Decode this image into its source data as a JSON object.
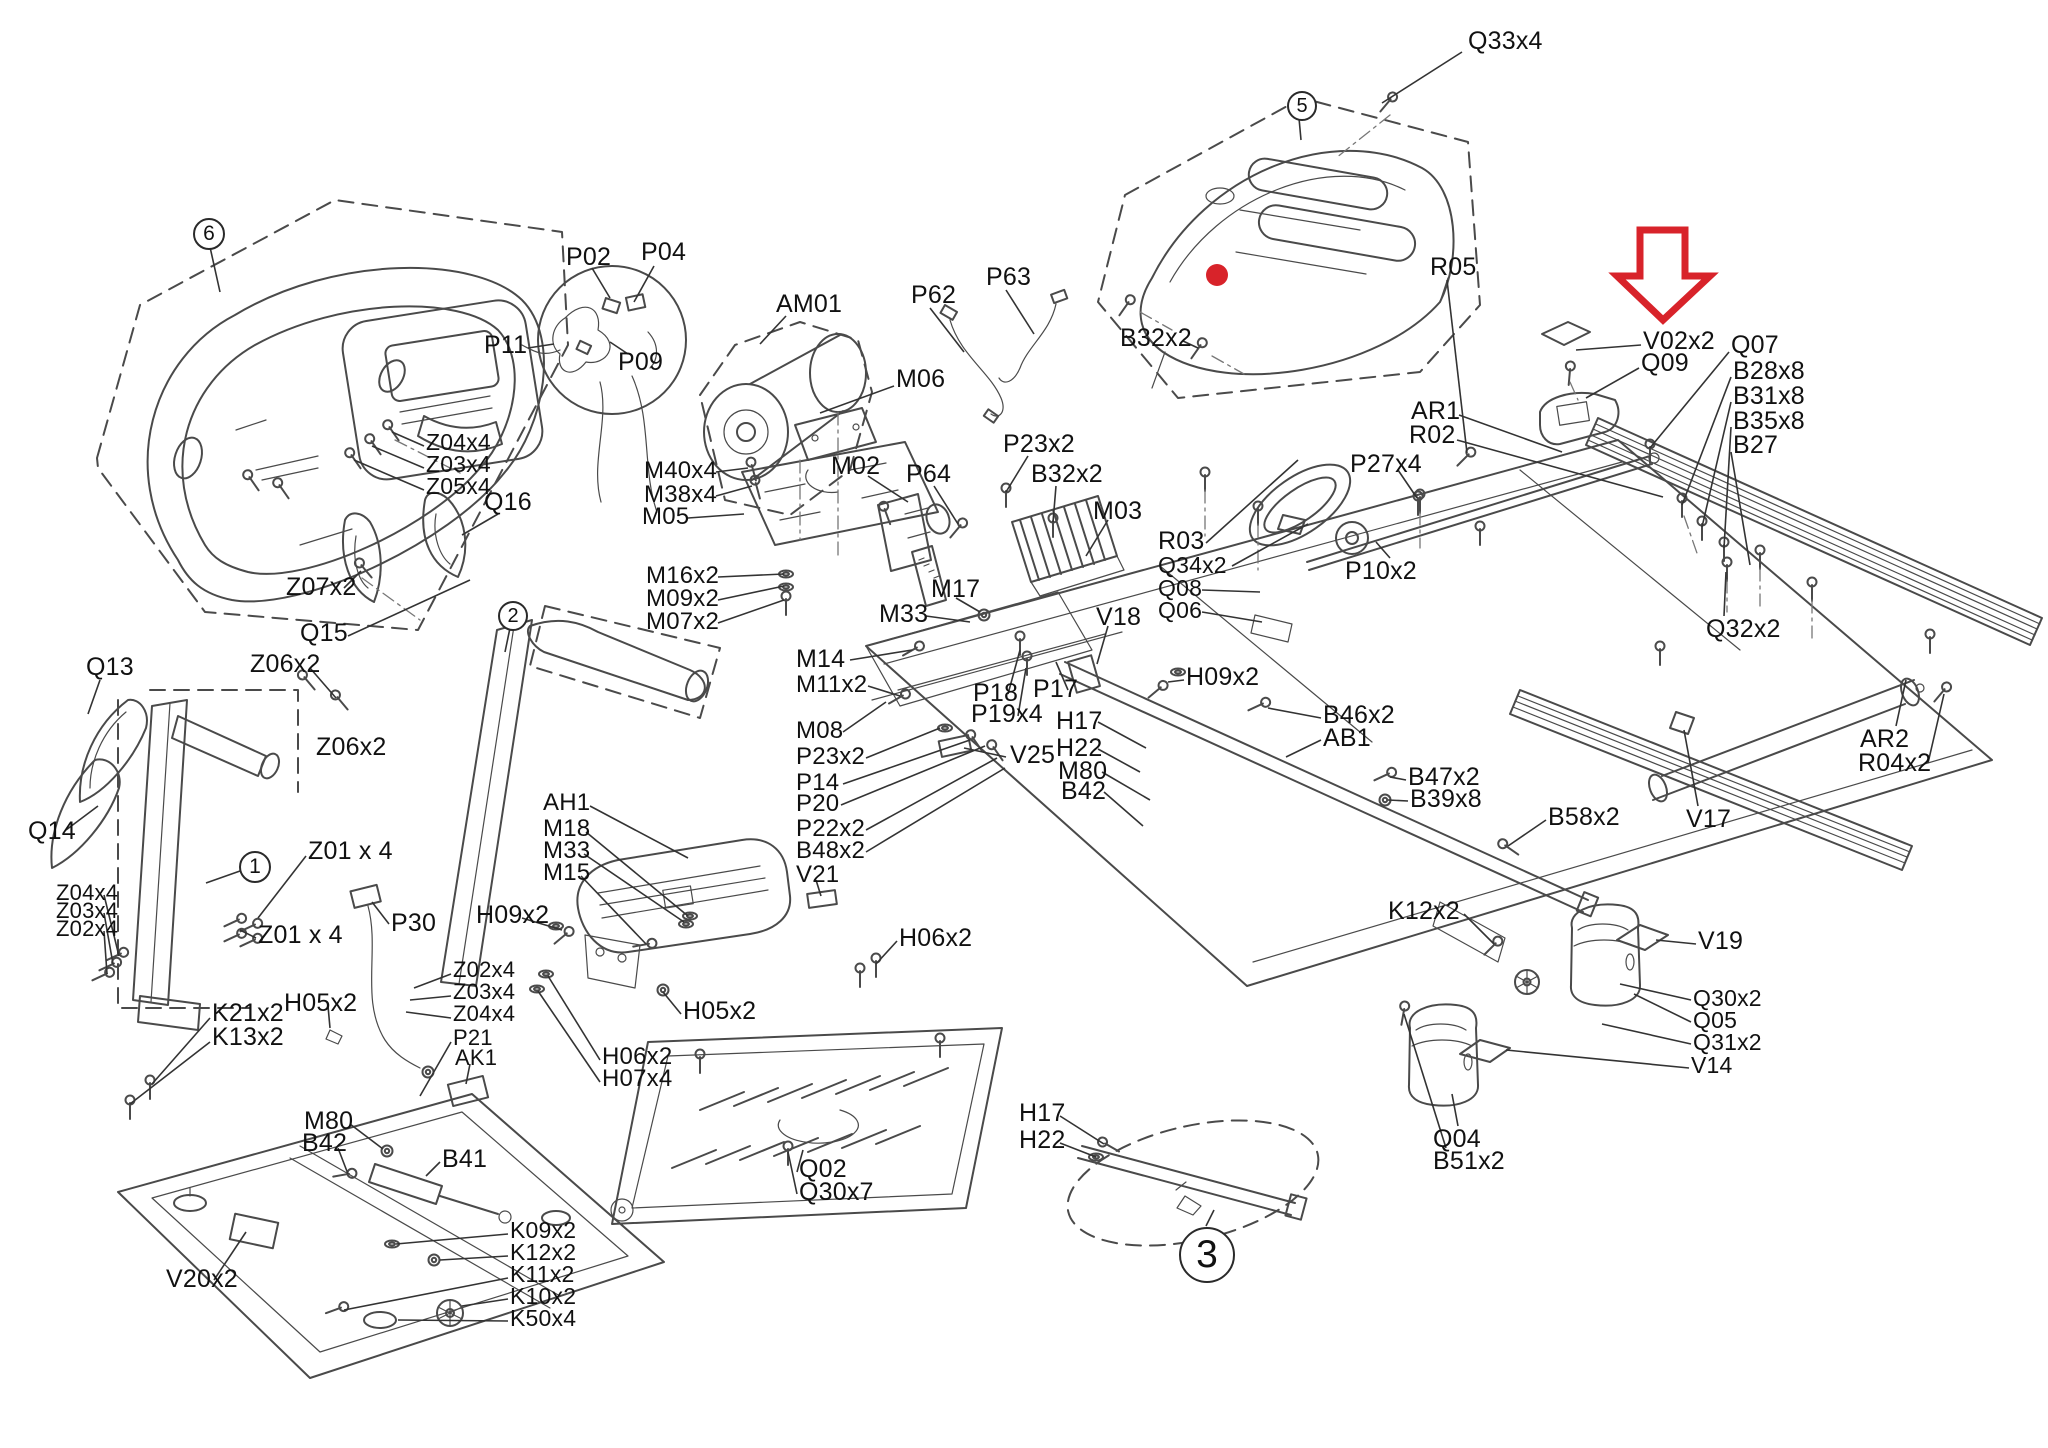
{
  "diagram_type": "exploded-parts-diagram",
  "subject": "treadmill parts schematic",
  "colors": {
    "line": "#4a4a4a",
    "label": "#111111",
    "red": "#d8232a",
    "bg": "#ffffff"
  },
  "highlight": {
    "arrow": {
      "x": 1617,
      "y": 228
    },
    "dot": {
      "x": 1217,
      "y": 275,
      "r": 11
    }
  },
  "balloons": [
    {
      "n": "6",
      "x": 207,
      "y": 232,
      "r": 14,
      "l": [
        210,
        247,
        220,
        292
      ]
    },
    {
      "n": "2",
      "x": 511,
      "y": 614,
      "r": 13,
      "l": [
        510,
        628,
        505,
        652
      ]
    },
    {
      "n": "1",
      "x": 253,
      "y": 865,
      "r": 14,
      "l": [
        240,
        871,
        206,
        883
      ]
    },
    {
      "n": "5",
      "x": 1300,
      "y": 104,
      "r": 13,
      "l": [
        1299,
        118,
        1301,
        140
      ]
    },
    {
      "n": "3",
      "x": 1205,
      "y": 1253,
      "r": 26,
      "l": [
        1206,
        1226,
        1214,
        1210
      ]
    }
  ],
  "callouts": [
    {
      "t": "Q33x4",
      "x": 1468,
      "y": 30,
      "l": [
        1462,
        52,
        1382,
        103
      ]
    },
    {
      "t": "V02x2",
      "x": 1643,
      "y": 330,
      "l": [
        1641,
        345,
        1576,
        350
      ]
    },
    {
      "t": "Q09",
      "x": 1641,
      "y": 352,
      "l": [
        1639,
        368,
        1586,
        398
      ]
    },
    {
      "t": "Q07",
      "x": 1731,
      "y": 334,
      "l": [
        1729,
        352,
        1650,
        448
      ]
    },
    {
      "t": "B28x8",
      "x": 1733,
      "y": 360,
      "l": [
        1731,
        377,
        1682,
        505
      ]
    },
    {
      "t": "B31x8",
      "x": 1733,
      "y": 385,
      "l": [
        1731,
        402,
        1702,
        527
      ]
    },
    {
      "t": "B35x8",
      "x": 1733,
      "y": 410,
      "l": [
        1731,
        427,
        1724,
        548
      ]
    },
    {
      "t": "B27",
      "x": 1733,
      "y": 434,
      "l": [
        1731,
        452,
        1750,
        565
      ]
    },
    {
      "t": "B32x2",
      "x": 1120,
      "y": 327,
      "l": [
        1183,
        341,
        1198,
        348
      ]
    },
    {
      "t": "R05",
      "x": 1430,
      "y": 256,
      "l": [
        1447,
        280,
        1467,
        453
      ]
    },
    {
      "t": "AR1",
      "x": 1411,
      "y": 400,
      "l": [
        1459,
        415,
        1562,
        452
      ]
    },
    {
      "t": "R02",
      "x": 1409,
      "y": 424,
      "l": [
        1457,
        440,
        1663,
        497
      ]
    },
    {
      "t": "P27x4",
      "x": 1350,
      "y": 453,
      "l": [
        1398,
        470,
        1417,
        498
      ]
    },
    {
      "t": "P10x2",
      "x": 1345,
      "y": 560,
      "l": [
        1390,
        558,
        1376,
        542
      ]
    },
    {
      "t": "R03",
      "x": 1158,
      "y": 530,
      "l": [
        1206,
        543,
        1298,
        460
      ]
    },
    {
      "t": "Q34x2",
      "x": 1158,
      "y": 555,
      "fs": 23,
      "l": [
        1232,
        566,
        1308,
        524
      ]
    },
    {
      "t": "Q08",
      "x": 1158,
      "y": 578,
      "fs": 23,
      "l": [
        1202,
        590,
        1260,
        592
      ]
    },
    {
      "t": "Q06",
      "x": 1158,
      "y": 600,
      "fs": 23,
      "l": [
        1202,
        612,
        1262,
        622
      ]
    },
    {
      "t": "Q32x2",
      "x": 1706,
      "y": 618,
      "l": [
        1724,
        616,
        1726,
        572
      ]
    },
    {
      "t": "AR2",
      "x": 1860,
      "y": 728,
      "l": [
        1896,
        726,
        1906,
        680
      ]
    },
    {
      "t": "R04x2",
      "x": 1858,
      "y": 752,
      "l": [
        1928,
        763,
        1944,
        694
      ]
    },
    {
      "t": "V17",
      "x": 1686,
      "y": 808,
      "l": [
        1698,
        806,
        1684,
        730
      ]
    },
    {
      "t": "B58x2",
      "x": 1548,
      "y": 806,
      "l": [
        1546,
        820,
        1508,
        846
      ]
    },
    {
      "t": "V19",
      "x": 1698,
      "y": 930,
      "l": [
        1696,
        944,
        1656,
        940
      ]
    },
    {
      "t": "Q30x2",
      "x": 1693,
      "y": 988,
      "fs": 23,
      "l": [
        1691,
        1000,
        1620,
        984
      ]
    },
    {
      "t": "Q05",
      "x": 1693,
      "y": 1010,
      "fs": 23,
      "l": [
        1691,
        1022,
        1634,
        994
      ]
    },
    {
      "t": "Q31x2",
      "x": 1693,
      "y": 1032,
      "fs": 23,
      "l": [
        1691,
        1044,
        1602,
        1024
      ]
    },
    {
      "t": "V14",
      "x": 1691,
      "y": 1055,
      "fs": 23,
      "l": [
        1689,
        1068,
        1506,
        1050
      ]
    },
    {
      "t": "Q04",
      "x": 1433,
      "y": 1128,
      "l": [
        1458,
        1126,
        1452,
        1094
      ]
    },
    {
      "t": "B51x2",
      "x": 1433,
      "y": 1150,
      "l": [
        1446,
        1148,
        1404,
        1014
      ]
    },
    {
      "t": "K12x2",
      "x": 1388,
      "y": 900,
      "l": [
        1464,
        914,
        1494,
        944
      ]
    },
    {
      "t": "M14",
      "x": 796,
      "y": 648,
      "l": [
        850,
        660,
        912,
        650
      ]
    },
    {
      "t": "M11x2",
      "x": 796,
      "y": 674,
      "fs": 24,
      "l": [
        868,
        686,
        900,
        696
      ]
    },
    {
      "t": "M08",
      "x": 796,
      "y": 720,
      "fs": 24,
      "l": [
        843,
        732,
        886,
        702
      ]
    },
    {
      "t": "P23x2",
      "x": 796,
      "y": 746,
      "fs": 24,
      "l": [
        866,
        758,
        940,
        728
      ]
    },
    {
      "t": "P14",
      "x": 796,
      "y": 772,
      "fs": 24,
      "l": [
        843,
        784,
        970,
        740
      ]
    },
    {
      "t": "P20",
      "x": 796,
      "y": 793,
      "fs": 24,
      "l": [
        841,
        805,
        985,
        746
      ]
    },
    {
      "t": "P22x2",
      "x": 796,
      "y": 818,
      "fs": 24,
      "l": [
        866,
        830,
        997,
        758
      ]
    },
    {
      "t": "B48x2",
      "x": 796,
      "y": 840,
      "fs": 24,
      "l": [
        866,
        852,
        1005,
        768
      ]
    },
    {
      "t": "V21",
      "x": 796,
      "y": 864,
      "fs": 24,
      "l": [
        816,
        880,
        821,
        896
      ]
    },
    {
      "t": "P18",
      "x": 973,
      "y": 682,
      "l": [
        1008,
        694,
        1020,
        650
      ]
    },
    {
      "t": "P19x4",
      "x": 971,
      "y": 703,
      "l": [
        1018,
        716,
        1026,
        668
      ]
    },
    {
      "t": "P17",
      "x": 1033,
      "y": 678,
      "l": [
        1068,
        690,
        1056,
        662
      ]
    },
    {
      "t": "V25",
      "x": 1010,
      "y": 744,
      "l": [
        1006,
        757,
        964,
        748
      ]
    },
    {
      "t": "H17",
      "x": 1056,
      "y": 710,
      "l": [
        1098,
        722,
        1146,
        748
      ]
    },
    {
      "t": "H22",
      "x": 1056,
      "y": 737,
      "l": [
        1098,
        749,
        1140,
        772
      ]
    },
    {
      "t": "M80",
      "x": 1058,
      "y": 760,
      "l": [
        1102,
        772,
        1150,
        800
      ]
    },
    {
      "t": "B42",
      "x": 1061,
      "y": 780,
      "l": [
        1104,
        792,
        1143,
        826
      ]
    },
    {
      "t": "H09x2",
      "x": 1186,
      "y": 666,
      "l": [
        1184,
        680,
        1168,
        682
      ]
    },
    {
      "t": "B46x2",
      "x": 1323,
      "y": 704,
      "l": [
        1321,
        718,
        1268,
        708
      ]
    },
    {
      "t": "AB1",
      "x": 1323,
      "y": 727,
      "l": [
        1321,
        740,
        1286,
        757
      ]
    },
    {
      "t": "B47x2",
      "x": 1408,
      "y": 766,
      "l": [
        1406,
        780,
        1390,
        777
      ]
    },
    {
      "t": "B39x8",
      "x": 1410,
      "y": 788,
      "l": [
        1408,
        801,
        1388,
        800
      ]
    },
    {
      "t": "Q13",
      "x": 86,
      "y": 656,
      "l": [
        100,
        680,
        88,
        714
      ]
    },
    {
      "t": "Z07x2",
      "x": 286,
      "y": 576,
      "l": [
        344,
        588,
        361,
        571
      ]
    },
    {
      "t": "Q15",
      "x": 300,
      "y": 622,
      "l": [
        348,
        636,
        470,
        580
      ]
    },
    {
      "t": "Z06x2",
      "x": 250,
      "y": 653,
      "l": [
        310,
        668,
        336,
        698
      ]
    },
    {
      "t": "Z06x2",
      "x": 316,
      "y": 736
    },
    {
      "t": "Q14",
      "x": 28,
      "y": 820,
      "l": [
        66,
        830,
        98,
        806
      ]
    },
    {
      "t": "Z04x4",
      "x": 56,
      "y": 883,
      "fs": 22,
      "l": [
        104,
        895,
        119,
        956
      ]
    },
    {
      "t": "Z03x4",
      "x": 56,
      "y": 901,
      "fs": 22,
      "l": [
        104,
        913,
        113,
        964
      ]
    },
    {
      "t": "Z02x4",
      "x": 56,
      "y": 919,
      "fs": 22,
      "l": [
        104,
        931,
        107,
        974
      ]
    },
    {
      "t": "Z01 x 4",
      "x": 308,
      "y": 840,
      "l": [
        306,
        856,
        258,
        918
      ]
    },
    {
      "t": "Z01 x 4",
      "x": 258,
      "y": 924,
      "l": [
        256,
        938,
        240,
        930
      ]
    },
    {
      "t": "P30",
      "x": 391,
      "y": 912,
      "l": [
        389,
        924,
        372,
        902
      ]
    },
    {
      "t": "K21x2",
      "x": 212,
      "y": 1002,
      "l": [
        210,
        1018,
        152,
        1084
      ]
    },
    {
      "t": "K13x2",
      "x": 212,
      "y": 1026,
      "l": [
        210,
        1042,
        130,
        1104
      ]
    },
    {
      "t": "H05x2",
      "x": 284,
      "y": 992,
      "l": [
        328,
        1006,
        330,
        1028
      ]
    },
    {
      "t": "Z02x4",
      "x": 453,
      "y": 960,
      "fs": 22,
      "l": [
        451,
        974,
        414,
        988
      ]
    },
    {
      "t": "Z03x4",
      "x": 453,
      "y": 982,
      "fs": 22,
      "l": [
        451,
        996,
        410,
        1000
      ]
    },
    {
      "t": "Z04x4",
      "x": 453,
      "y": 1004,
      "fs": 22,
      "l": [
        451,
        1018,
        406,
        1012
      ]
    },
    {
      "t": "P21",
      "x": 453,
      "y": 1028,
      "fs": 22,
      "l": [
        451,
        1042,
        420,
        1096
      ]
    },
    {
      "t": "AK1",
      "x": 455,
      "y": 1048,
      "fs": 22,
      "l": [
        470,
        1064,
        466,
        1084
      ]
    },
    {
      "t": "H09x2",
      "x": 476,
      "y": 904,
      "l": [
        522,
        918,
        562,
        930
      ]
    },
    {
      "t": "AH1",
      "x": 543,
      "y": 792,
      "fs": 24,
      "l": [
        590,
        806,
        688,
        858
      ]
    },
    {
      "t": "M18",
      "x": 543,
      "y": 818,
      "fs": 24,
      "l": [
        586,
        832,
        688,
        916
      ]
    },
    {
      "t": "M33",
      "x": 543,
      "y": 840,
      "fs": 24,
      "l": [
        584,
        854,
        684,
        922
      ]
    },
    {
      "t": "M15",
      "x": 543,
      "y": 862,
      "fs": 24,
      "l": [
        581,
        876,
        646,
        944
      ]
    },
    {
      "t": "H05x2",
      "x": 683,
      "y": 1000,
      "l": [
        681,
        1014,
        663,
        992
      ]
    },
    {
      "t": "H06x2",
      "x": 602,
      "y": 1046,
      "fs": 24,
      "l": [
        600,
        1060,
        548,
        976
      ]
    },
    {
      "t": "H07x4",
      "x": 602,
      "y": 1068,
      "fs": 24,
      "l": [
        600,
        1082,
        538,
        991
      ]
    },
    {
      "t": "H06x2",
      "x": 899,
      "y": 927,
      "l": [
        897,
        941,
        876,
        964
      ]
    },
    {
      "t": "M80",
      "x": 304,
      "y": 1110,
      "l": [
        350,
        1124,
        383,
        1149
      ]
    },
    {
      "t": "B42",
      "x": 302,
      "y": 1132,
      "l": [
        338,
        1148,
        348,
        1174
      ]
    },
    {
      "t": "B41",
      "x": 442,
      "y": 1148,
      "l": [
        440,
        1162,
        426,
        1176
      ]
    },
    {
      "t": "V20x2",
      "x": 166,
      "y": 1268,
      "l": [
        214,
        1280,
        246,
        1232
      ]
    },
    {
      "t": "K09x2",
      "x": 510,
      "y": 1220,
      "fs": 23,
      "l": [
        508,
        1234,
        396,
        1244
      ]
    },
    {
      "t": "K12x2",
      "x": 510,
      "y": 1242,
      "fs": 23,
      "l": [
        508,
        1256,
        440,
        1260
      ]
    },
    {
      "t": "K11x2",
      "x": 510,
      "y": 1264,
      "fs": 23,
      "l": [
        508,
        1278,
        344,
        1310
      ]
    },
    {
      "t": "K10x2",
      "x": 510,
      "y": 1286,
      "fs": 23,
      "l": [
        508,
        1299,
        462,
        1306
      ]
    },
    {
      "t": "K50x4",
      "x": 510,
      "y": 1308,
      "fs": 23,
      "l": [
        508,
        1321,
        398,
        1320
      ]
    },
    {
      "t": "Q02",
      "x": 799,
      "y": 1158,
      "l": [
        797,
        1172,
        803,
        1150
      ]
    },
    {
      "t": "Q30x7",
      "x": 799,
      "y": 1181,
      "l": [
        797,
        1194,
        788,
        1152
      ]
    },
    {
      "t": "H17",
      "x": 1019,
      "y": 1102,
      "l": [
        1060,
        1116,
        1104,
        1144
      ]
    },
    {
      "t": "H22",
      "x": 1019,
      "y": 1129,
      "l": [
        1060,
        1143,
        1096,
        1157
      ]
    },
    {
      "t": "P02",
      "x": 566,
      "y": 246,
      "l": [
        592,
        268,
        610,
        298
      ]
    },
    {
      "t": "P04",
      "x": 641,
      "y": 241,
      "l": [
        654,
        266,
        634,
        302
      ]
    },
    {
      "t": "P09",
      "x": 618,
      "y": 351,
      "l": [
        628,
        354,
        610,
        342
      ]
    },
    {
      "t": "P11",
      "x": 484,
      "y": 334,
      "l": [
        528,
        348,
        554,
        344
      ]
    },
    {
      "t": "AM01",
      "x": 776,
      "y": 293,
      "l": [
        786,
        316,
        760,
        344
      ]
    },
    {
      "t": "M06",
      "x": 896,
      "y": 368,
      "l": [
        894,
        386,
        820,
        413
      ]
    },
    {
      "t": "P62",
      "x": 911,
      "y": 284,
      "l": [
        930,
        308,
        964,
        352
      ]
    },
    {
      "t": "P63",
      "x": 986,
      "y": 266,
      "l": [
        1006,
        290,
        1034,
        334
      ]
    },
    {
      "t": "P23x2",
      "x": 1003,
      "y": 433,
      "l": [
        1028,
        456,
        1006,
        492
      ]
    },
    {
      "t": "B32x2",
      "x": 1031,
      "y": 463,
      "l": [
        1056,
        486,
        1053,
        522
      ]
    },
    {
      "t": "M03",
      "x": 1093,
      "y": 500,
      "l": [
        1108,
        520,
        1086,
        556
      ]
    },
    {
      "t": "M17",
      "x": 931,
      "y": 578,
      "l": [
        956,
        598,
        980,
        612
      ]
    },
    {
      "t": "M33",
      "x": 879,
      "y": 603,
      "l": [
        926,
        616,
        970,
        622
      ]
    },
    {
      "t": "V18",
      "x": 1096,
      "y": 606,
      "l": [
        1108,
        626,
        1097,
        664
      ]
    },
    {
      "t": "M40x4",
      "x": 644,
      "y": 460,
      "fs": 24,
      "l": [
        716,
        472,
        748,
        468
      ]
    },
    {
      "t": "M38x4",
      "x": 644,
      "y": 484,
      "fs": 24,
      "l": [
        716,
        496,
        752,
        486
      ]
    },
    {
      "t": "M05",
      "x": 642,
      "y": 506,
      "fs": 24,
      "l": [
        688,
        518,
        744,
        514
      ]
    },
    {
      "t": "M16x2",
      "x": 646,
      "y": 565,
      "fs": 24,
      "l": [
        718,
        577,
        784,
        574
      ]
    },
    {
      "t": "M09x2",
      "x": 646,
      "y": 588,
      "fs": 24,
      "l": [
        718,
        600,
        784,
        586
      ]
    },
    {
      "t": "M07x2",
      "x": 646,
      "y": 611,
      "fs": 24,
      "l": [
        718,
        623,
        784,
        600
      ]
    },
    {
      "t": "M02",
      "x": 831,
      "y": 455,
      "l": [
        868,
        476,
        908,
        502
      ]
    },
    {
      "t": "P64",
      "x": 906,
      "y": 463,
      "l": [
        934,
        486,
        958,
        524
      ]
    },
    {
      "t": "Z04x4",
      "x": 426,
      "y": 432,
      "fs": 23,
      "l": [
        424,
        446,
        392,
        432
      ]
    },
    {
      "t": "Z03x4",
      "x": 426,
      "y": 454,
      "fs": 23,
      "l": [
        424,
        468,
        372,
        446
      ]
    },
    {
      "t": "Z05x4",
      "x": 426,
      "y": 476,
      "fs": 23,
      "l": [
        424,
        490,
        354,
        460
      ]
    },
    {
      "t": "Q16",
      "x": 484,
      "y": 491,
      "l": [
        498,
        514,
        462,
        535
      ]
    }
  ]
}
